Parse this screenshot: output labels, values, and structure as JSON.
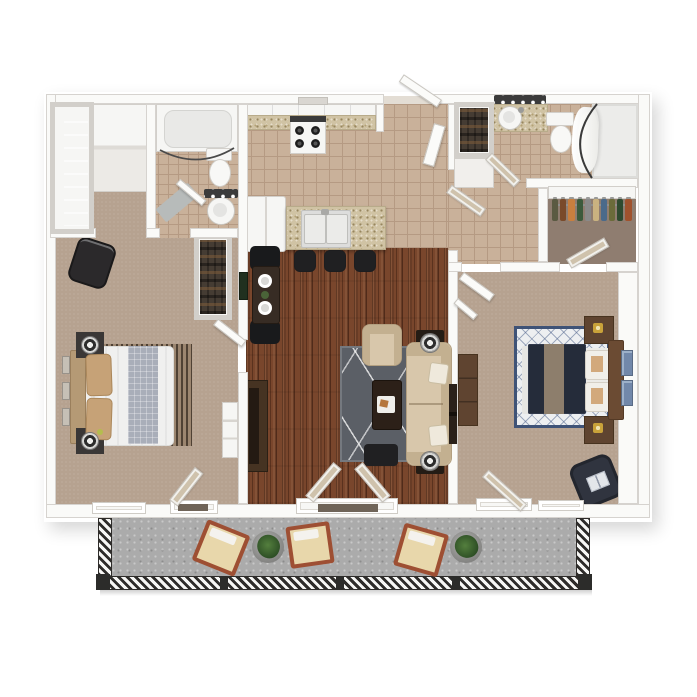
{
  "scene": {
    "kind": "apartment-floor-plan-3d-render",
    "view": "top-down",
    "rooms": [
      "master-suite-hall",
      "bathroom-1",
      "kitchen",
      "entry-hall",
      "bathroom-2",
      "walk-in-closet",
      "bedroom-left",
      "dining-nook",
      "living-room",
      "bedroom-right",
      "balcony"
    ]
  },
  "counts": {
    "balcony_chairs": 3,
    "balcony_plants": 2,
    "bar_stools": 3,
    "dining_chairs": 2,
    "dining_plates": 2,
    "bedroom_left_wall_frames": 3,
    "bedroom_right_art_frames": 2
  },
  "colors": {
    "wall": "#fafaf8",
    "wall_edge": "#d6d3cf",
    "fixture": "#f6f6f4",
    "fixture_edge": "#d2cfca",
    "carpet": "#b6a290",
    "tile": "#c9b19a",
    "tile_line": "#b59a83",
    "wood": "#79462c",
    "rug_gray": "#5b5f66",
    "sofa": "#d8c7ab",
    "sofa_dark": "#c3b090",
    "table_dark": "#2c2018",
    "black_furniture": "#202022",
    "island": "#d0c3a4",
    "island_fleck": "#97865f",
    "balcony": "#ababab",
    "rail_dark": "#2e2c2a",
    "patio_frame": "#9e4f33",
    "patio_cushion": "#e8d7ab",
    "plant": "#2c4d24",
    "bed2": "#252c3a",
    "runner2": "#8d7e6c",
    "wood_brown": "#5f4430",
    "headboard2": "#6b4b33",
    "rug2_border": "#3f5377",
    "art_blue": "#7288aa",
    "bed1": "#f0f0ef",
    "pillow1": "#c6a277",
    "headboard1": "#b59a75",
    "runner1": "#a9aeb9",
    "stripe_dark": "#4f4134",
    "stripe_light": "#9c8670",
    "closet_floor": "#8f7d70",
    "leaf_glass": "#cfc2ac",
    "mat": "#b7bbba",
    "navy_chair": "#30343f",
    "console": "#463322"
  }
}
